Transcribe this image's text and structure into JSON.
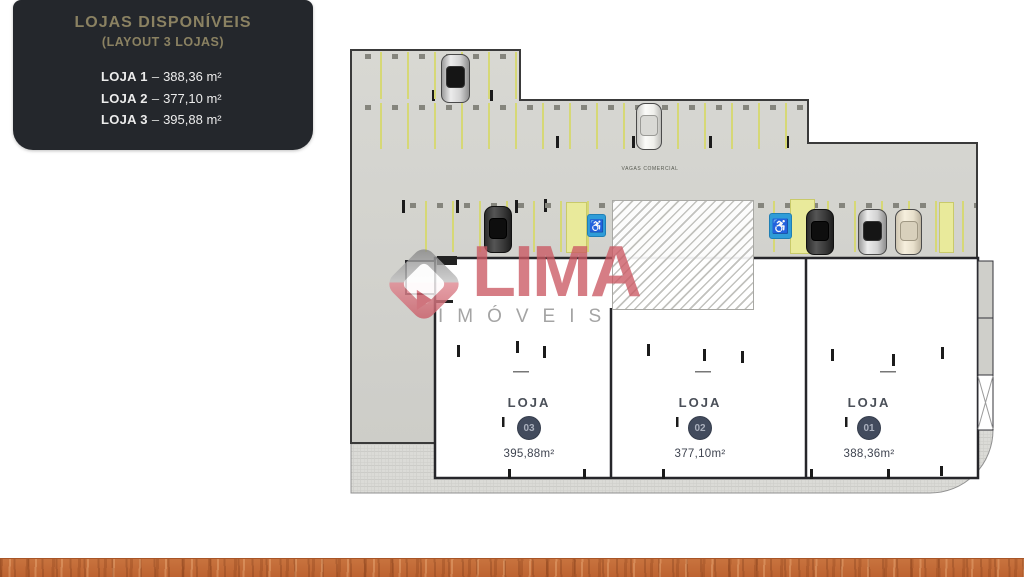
{
  "panel": {
    "title": "LOJAS DISPONÍVEIS",
    "subtitle": "(LAYOUT 3 LOJAS)",
    "separator": "–",
    "items": [
      {
        "name": "LOJA 1",
        "area": "388,36 m²"
      },
      {
        "name": "LOJA 2",
        "area": "377,10 m²"
      },
      {
        "name": "LOJA 3",
        "area": "395,88 m²"
      }
    ]
  },
  "watermark": {
    "brand": "LIMA",
    "tagline": "IMÓVEIS"
  },
  "plan": {
    "aisle_label": "VAGAS COMERCIAL",
    "accessible_icon": "♿",
    "stores": [
      {
        "label": "LOJA",
        "number": "03",
        "area": "395,88m²"
      },
      {
        "label": "LOJA",
        "number": "02",
        "area": "377,10m²"
      },
      {
        "label": "LOJA",
        "number": "01",
        "area": "388,36m²"
      }
    ]
  },
  "colors": {
    "panel_bg": "#24272C",
    "panel_accent_gold": "#8B8262",
    "brand_red": "#CA5B63",
    "accessible_blue": "#2F9CD8",
    "stall_yellow": "#D6D876",
    "concrete": "#D3D3CE",
    "wood_bar": "#C26D38"
  }
}
